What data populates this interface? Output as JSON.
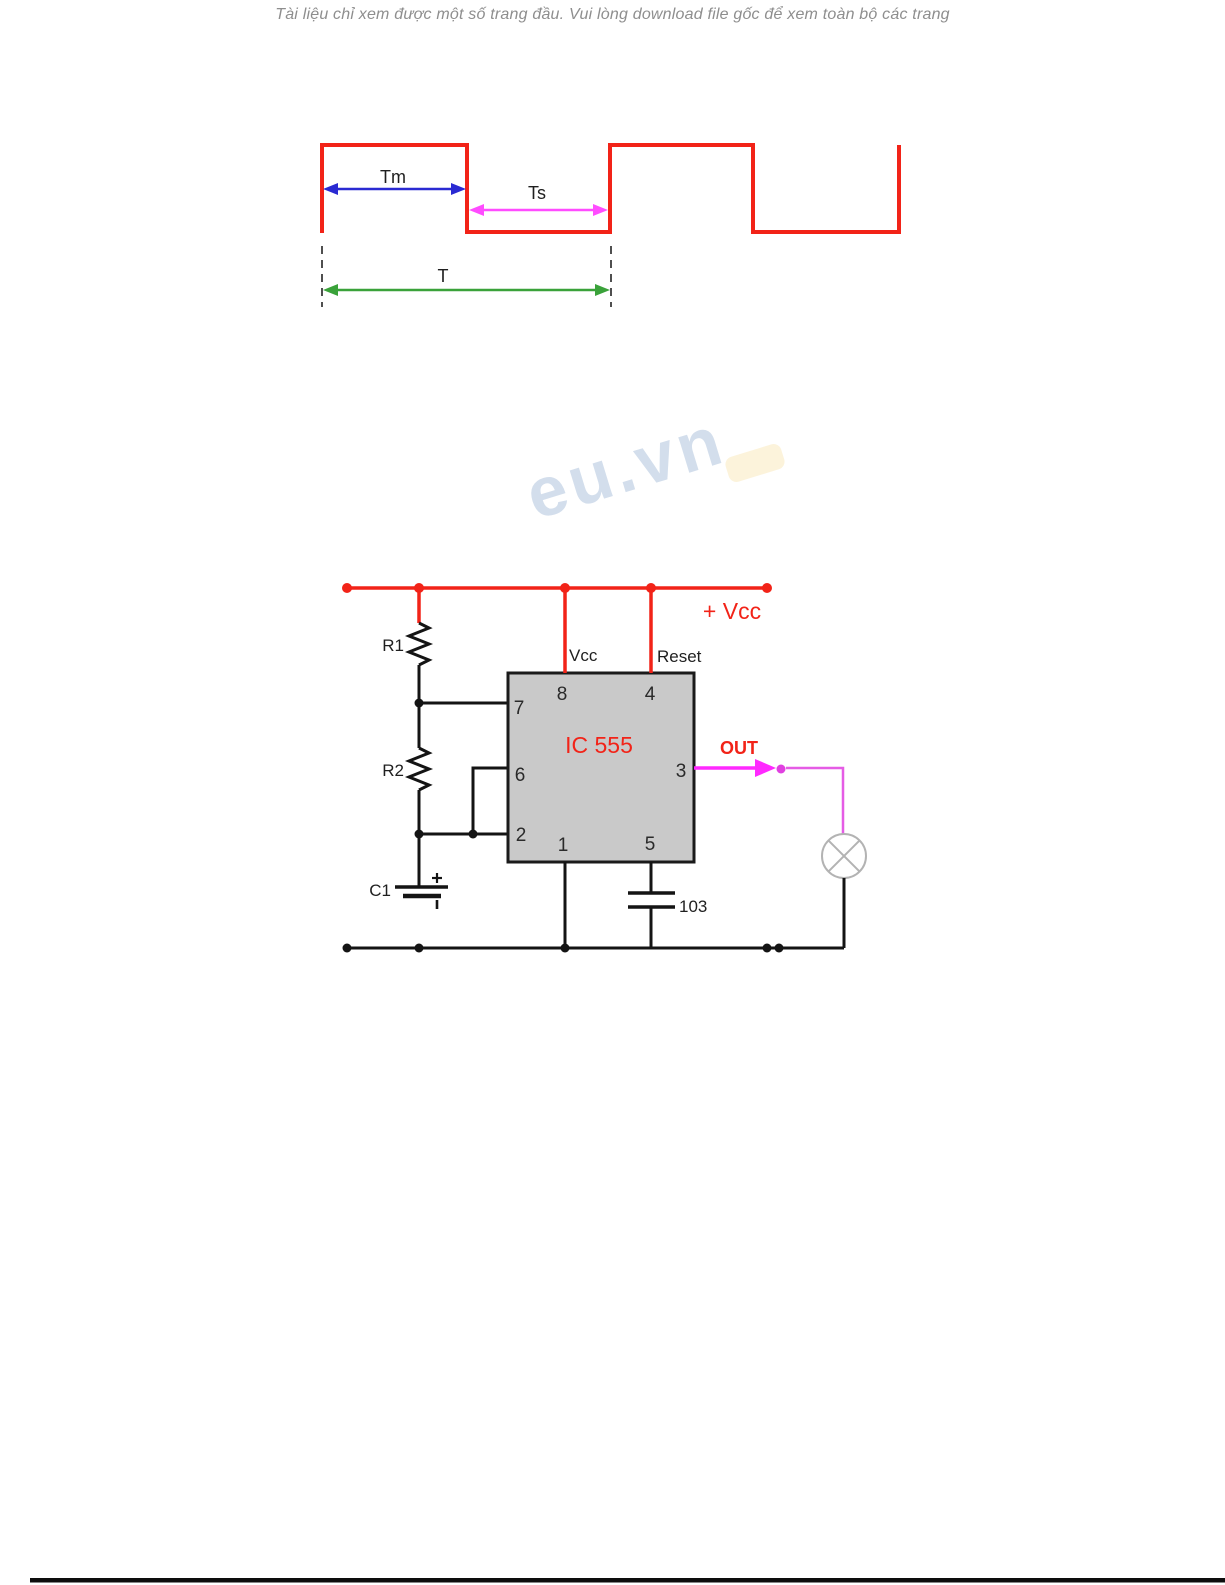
{
  "header": {
    "notice": "Tài liệu chỉ xem được một số trang đầu. Vui lòng download file gốc để xem toàn bộ các trang"
  },
  "waveform": {
    "tm_label": "Tm",
    "ts_label": "Ts",
    "t_label": "T"
  },
  "circuit": {
    "supply_label": "+ Vcc",
    "vcc_pin_label": "Vcc",
    "reset_pin_label": "Reset",
    "ic_label": "IC 555",
    "out_label": "OUT",
    "r1_label": "R1",
    "r2_label": "R2",
    "c1_label": "C1",
    "bypass_cap_value": "103",
    "pins": {
      "p1": "1",
      "p2": "2",
      "p3": "3",
      "p4": "4",
      "p5": "5",
      "p6": "6",
      "p7": "7",
      "p8": "8"
    }
  },
  "watermark": {
    "text": "eu.vn"
  },
  "colors": {
    "trace_red": "#f22318",
    "arrow_blue": "#2a2ad2",
    "arrow_magenta": "#ff4cff",
    "arrow_green": "#3aa23a",
    "out_magenta": "#ff29ff",
    "ic_fill": "#c9c9c9",
    "lamp_gray": "#b3b3b3",
    "notice_gray": "#8e8e8e",
    "watermark_blue": "#ccd9e9"
  }
}
